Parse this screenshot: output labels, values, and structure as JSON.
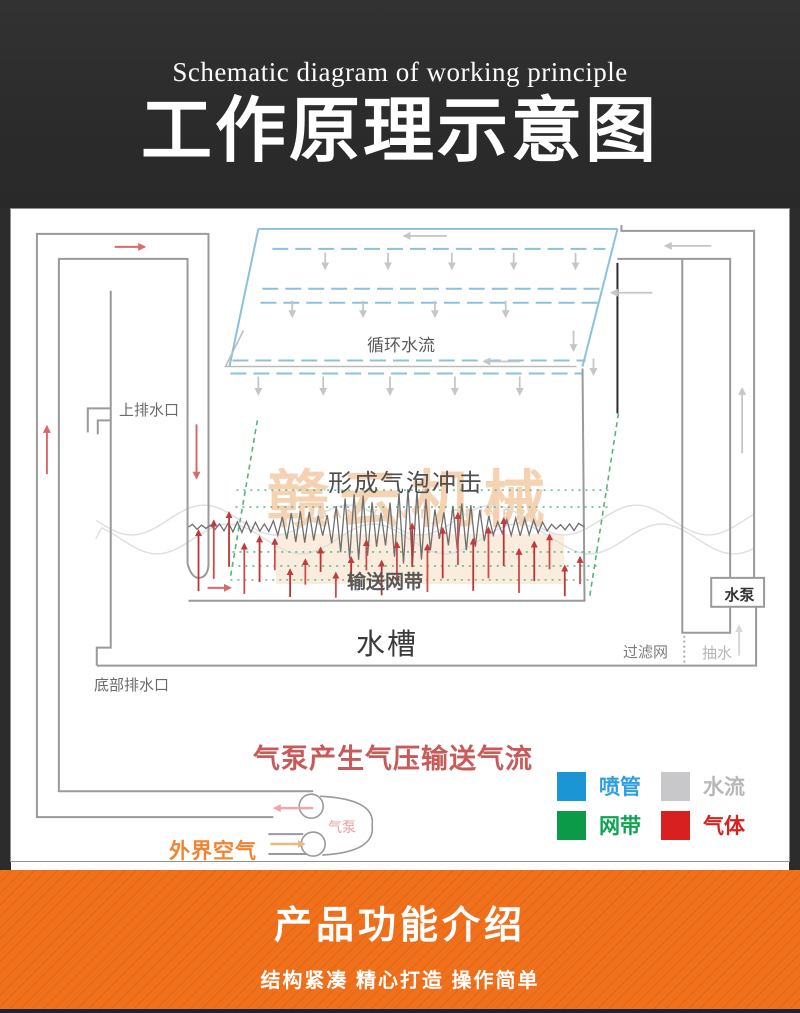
{
  "hero": {
    "subtitle_en": "Schematic diagram of working principle",
    "title_zh": "工作原理示意图"
  },
  "diagram": {
    "labels": {
      "circulating_water": "循环水流",
      "upper_drain": "上排水口",
      "bubble_impact": "形成气泡冲击",
      "conveyor_belt": "输送网带",
      "water_tank": "水槽",
      "filter_net": "过滤网",
      "pump_water": "抽水",
      "water_pump": "水泵",
      "bottom_drain": "底部排水口",
      "air_pressure_note": "气泵产生气压输送气流",
      "outside_air": "外界空气",
      "air_pump": "气泵"
    },
    "watermark": {
      "text_zh": "赣云机械",
      "text_en": "GAN YUN MACHINERY"
    },
    "legend": {
      "items": [
        {
          "label": "喷管",
          "color": "#1a96d5"
        },
        {
          "label": "水流",
          "color": "#c8c8ca"
        },
        {
          "label": "网带",
          "color": "#0b9a48"
        },
        {
          "label": "气体",
          "color": "#d7201f"
        }
      ]
    },
    "colors": {
      "spray_pipe_blue": "#8cc1de",
      "belt_green": "#55b47e",
      "gas_red": "#c23a3a",
      "water_gray": "#c6c6c6",
      "pipe_gray": "#9a9a9a",
      "note_red": "#c85a5a",
      "outside_air_orange": "#f08433"
    }
  },
  "footer": {
    "title": "产品功能介绍",
    "tagline": "结构紧凑  精心打造  操作简单",
    "accent_orange": "#f0701c"
  }
}
